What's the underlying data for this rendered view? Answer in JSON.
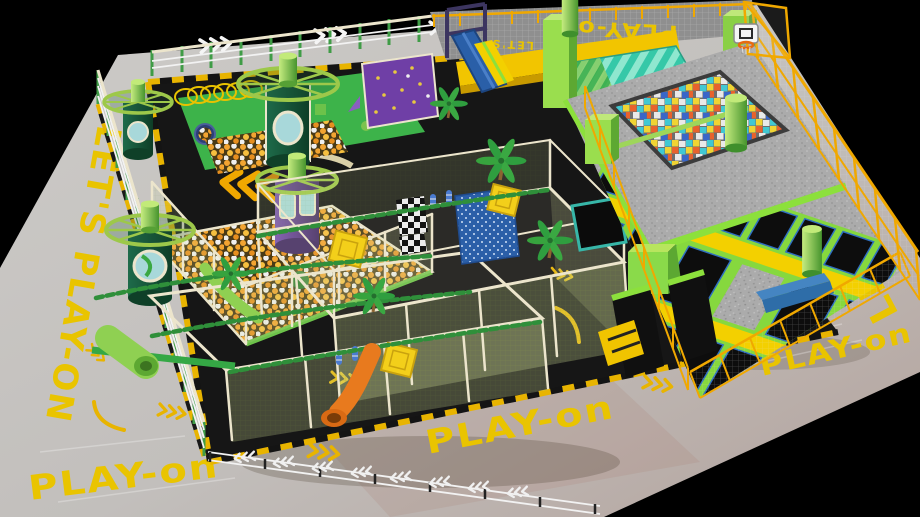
{
  "scene": {
    "brand": "PLAY-on",
    "type": "indoor-playground-trampoline-park-render"
  },
  "floor_texts": {
    "bottom_center": "PLAY-on",
    "bottom_left": "PLAY-on",
    "bottom_right": "PLAY-on",
    "left_band": "LET'S PLAY-ON",
    "right_band": "LET'S PLAY-on",
    "mezzanine_reversed": "PLAY-on",
    "mezzanine_small": "LET'S"
  },
  "features": {
    "ring_towers": 4,
    "palm_trees": 5,
    "trampoline_rows": 3,
    "basketball_hoops": 1,
    "foam_cube_pits": 1,
    "ball_pits": 2,
    "slides": [
      "orange-spiral-tube",
      "blue-straight",
      "yellow-straight",
      "teal-wave-slope"
    ]
  },
  "colors": {
    "background": "#000000",
    "floor_gray": "#c9c7c4",
    "floor_gray_shadow": "#b5a49e",
    "marking_yellow": "#e9c400",
    "track_black": "#161616",
    "frame_cream": "#ece5cc",
    "jungle_green": "#2f8f3a",
    "lime_green": "#8ce03c",
    "tower_green_dark": "#1e6b4a",
    "tower_purple": "#7a55b0",
    "window_teal": "#a8d8da",
    "purple_wall": "#6f3fa6",
    "ball_orange": "#f2a431",
    "ball_white": "#efefef",
    "foam_colors": [
      "#e8622d",
      "#41c8d2",
      "#f0d433",
      "#e9e9e9",
      "#3a66c8"
    ],
    "trampoline_bed": "#0d0d0d",
    "trampoline_stitch_blue": "#2f6fc0",
    "pad_yellow": "#f3d000",
    "fence_yellow": "#f0a800",
    "guardrail_green": "#3f9c46",
    "slide_orange": "#e87a1e",
    "slide_blue": "#2a5fa8",
    "wave_teal": "#35c8a8",
    "platform_speckle": "#ababab",
    "vault_blue": "#2e6da8"
  }
}
